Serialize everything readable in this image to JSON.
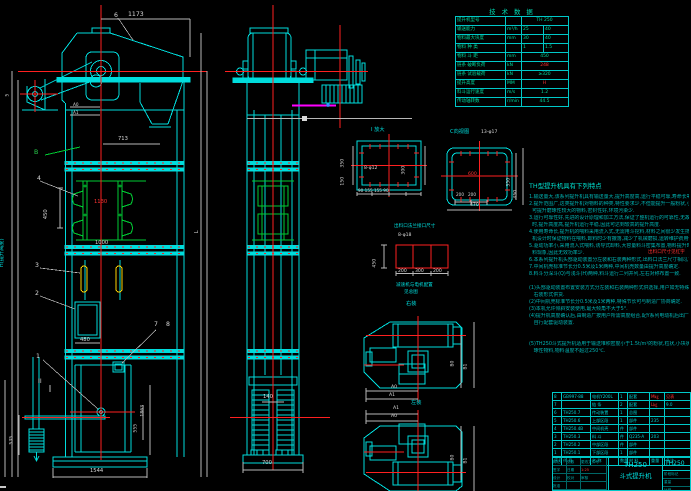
{
  "colors": {
    "background": "#000000",
    "line_cyan": "#00dcdc",
    "line_red": "#ff2020",
    "line_green": "#00cc33",
    "line_yellow": "#ffd400",
    "line_magenta": "#ff00ff",
    "text_white": "#d8d8d8"
  },
  "views": {
    "front": {
      "dims": {
        "w1173": "1173",
        "w713": "713",
        "p450": "450",
        "s1130": "1130",
        "s1000": "1000",
        "d480": "480",
        "base1544": "1544",
        "h1545": "1545",
        "h535": "535",
        "h1863": "1863",
        "h555": "555",
        "hLabel": "H(提升高度)",
        "lLabel": "L",
        "a0": "A0",
        "a1": "A1",
        "n50": "50"
      },
      "parts": {
        "p1": "1",
        "p2": "2",
        "p3": "3",
        "p4": "4",
        "p5": "5",
        "p6": "6",
        "p7": "7",
        "p8": "8",
        "pB": "B",
        "pII": "II"
      }
    },
    "side": {
      "dims": {
        "w700": "700",
        "w140": "140"
      }
    },
    "plan": {
      "right_install": "右装",
      "left_install": "左装",
      "a0": "A0",
      "a1": "A1",
      "b0": "B0",
      "b1": "B1"
    }
  },
  "details": {
    "i": {
      "title": "I 放大",
      "bolts": "8-φ12",
      "d350": "350",
      "d150": "150",
      "d300": "300",
      "seg": "90 155 155 90"
    },
    "c": {
      "title": "C向视图",
      "bolts": "13-φ17",
      "d600": "600",
      "d350": "350",
      "d450": "450",
      "d470": "470",
      "seg": "200   200"
    },
    "flange": {
      "title": "出料口法兰接口尺寸",
      "bolts": "8-φ18",
      "h450": "450",
      "w200a": "200",
      "w300": "300",
      "w200b": "200"
    },
    "gearnote1": "减速机与电机配置",
    "gearnote2": "见总图"
  },
  "tech_table": {
    "title": "技 术 数 据",
    "rows": [
      {
        "label": "提升机型号",
        "unit": "",
        "v1": "TH 250",
        "v2": "",
        "span": true,
        "red": false
      },
      {
        "label": "输送能力",
        "unit": "m³/h",
        "v1": "25",
        "v2": "40",
        "span": false,
        "red": false
      },
      {
        "label": "物料最大块度",
        "unit": "mm",
        "v1": "30",
        "v2": "40",
        "span": false,
        "red": false
      },
      {
        "label": "物料 种 类",
        "unit": "",
        "v1": "1",
        "v2": "1.5",
        "span": false,
        "red": false
      },
      {
        "label": "物料 斗 距",
        "unit": "mm",
        "v1": "450",
        "v2": "",
        "span": true,
        "red": false
      },
      {
        "label": "链条 破断负荷",
        "unit": "kN",
        "v1": "248",
        "v2": "",
        "span": true,
        "red": true
      },
      {
        "label": "链条 试验载荷",
        "unit": "kN",
        "v1": "≥320",
        "v2": "",
        "span": true,
        "red": false
      },
      {
        "label": "提升高度",
        "unit": "MM",
        "v1": "H",
        "v2": "",
        "span": true,
        "red": true
      },
      {
        "label": "料斗运行速度",
        "unit": "m/s",
        "v1": "1.2",
        "v2": "",
        "span": true,
        "red": false
      },
      {
        "label": "传动轴转数",
        "unit": "r/min",
        "v1": "44.5",
        "v2": "",
        "span": true,
        "red": false
      }
    ]
  },
  "features": {
    "title": "TH型提升机具有下列特点",
    "red_note": "出料口尺寸见红字",
    "lines": [
      "1.输送量大,该系列提升机具有输送量大,提升高度高,运行平稳可靠,寿命长等显著优点.",
      "2.提升范围广,这类提升机对物料的种类,特性要求少,不但能提升一般粉状,小颗粒状物料,而且",
      "  可提升磨琢性较大的物料,密封性好,环境污染少.",
      "3.运行可靠性好,先进的设计原理和加工方法,保证了整机运行的可靠性,无故障时间超过2万小",
      "  时,提升高度高,提升机运行平稳,因此可达到较高的提升高度.",
      "4.使用寿命长,提升机的喂料采用流入式,无需用斗挖料,材料之间很少发生挤压和碰撞现象,本",
      "  机设计时保证物料在喂料,卸料时少有撒落,减少了机械磨损,运转维护费用低.",
      "5.驱动功率小,采用流入式喂料,诱导式卸料,大容量料斗密集布置,物料提升时几乎无回料和挖",
      "  料现象,因此无效功率少.",
      "6.本系列提升机头部驱动装置分左装和右装两种形式,出料口法兰尺寸相同,可按需要选用.",
      "7.中间机壳标准节长分0.5米及1米两种,中间机壳数量由提升高度确定.",
      "8.料斗分深斗(Q)与浅斗(H)两种,料斗运行二列并列,左右对称布置一致.",
      "",
      "(1)头部驱动装置布置安装方式分左装和右装两种形式供选择,用户如无特殊要求时,制造厂按",
      "   右装形式供货.",
      "(2)中间机壳标准节长分0.5米及1米两种,特殊节长可与制造厂协商确定.",
      "(3)本机允许倾斜安装使用,最大倾角不大于5°.",
      "(4)提升机高度确认后,由制造厂按用户所需高度组合,配Y系列电动机后出厂,用户亦可按需要",
      "   自行配套驱动装置.",
      "",
      "",
      "(5)TH250斗式提升机适用于输送堆积密度小于1.5t/m³的粉状,粒状,小块状的无磨琢性,半磨",
      "   琢性物料,物料温度不超过250℃."
    ]
  },
  "bom": {
    "header": [
      "序号",
      "代 号",
      "名 称",
      "数量",
      "材 料",
      "重量",
      "备注"
    ],
    "rows": [
      [
        "8",
        "GB997-88",
        "电机Y200L",
        "1",
        "配套",
        "!M㎏",
        "!见表"
      ],
      [
        "7",
        "",
        "链 条",
        "2",
        "配套",
        "!L㎏",
        "9.0"
      ],
      [
        "6",
        "TH250.7",
        "传动装置",
        "1",
        "总图",
        "",
        ""
      ],
      [
        "5",
        "TH250.6",
        "上部区段",
        "1",
        "部件",
        "235",
        ""
      ],
      [
        "4",
        "TH250.4B",
        "中间机壳",
        "件",
        "部件",
        "",
        ""
      ],
      [
        "3",
        "TH250.3",
        "料 斗",
        "件",
        "Q235-A",
        "203",
        ""
      ],
      [
        "2",
        "TH250.2",
        "中部区段",
        "件",
        "部件",
        "",
        ""
      ],
      [
        "1",
        "TH250.1",
        "下部区段",
        "1",
        "部件",
        "",
        ""
      ]
    ]
  },
  "title_block": {
    "model": "TH250",
    "product": "斗式提升机",
    "drawing_no": "TH250",
    "cells": {
      "c1": "标记",
      "c2": "处数",
      "c3": "更改文件号",
      "c4": "签字",
      "c5": "日期",
      "c6": "设计",
      "c7": "校对",
      "c8": "审核",
      "c9": "批准"
    },
    "scale": "1:25",
    "right_cells": {
      "r1": "阶段标记",
      "r2": "重量",
      "r3": "比例"
    }
  }
}
